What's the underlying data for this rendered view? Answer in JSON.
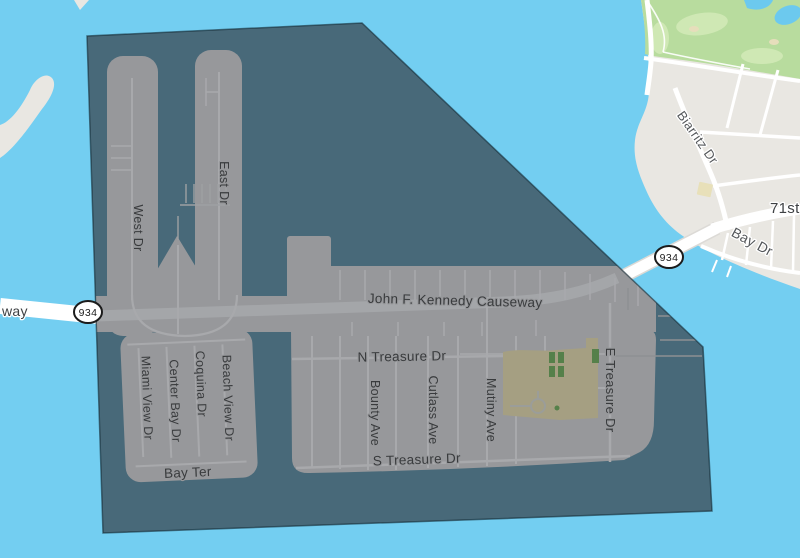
{
  "map": {
    "view": "street-map-with-selected-region-overlay",
    "colors": {
      "water": "#73cef1",
      "overlay_water": "#486979",
      "overlay_land": "#97989b",
      "overlay_road": "#a8a9ac",
      "land": "#e9e7e2",
      "road": "#ffffff",
      "golf_green": "#b8dc9e",
      "golf_green_light": "#cfe8b4",
      "pond_blue": "#6cc9ee",
      "park_tan_dimmed": "#a59f82",
      "park_green_dimmed": "#55804a",
      "building_beige": "#e8e0b9",
      "label_dimmed": "#393b3d",
      "label_outside": "#54575a"
    },
    "shields": {
      "west": "934",
      "east": "934"
    },
    "labels": {
      "partial_causeway": "way",
      "causeway": "John F. Kennedy Causeway",
      "west_dr": "West Dr",
      "east_dr": "East Dr",
      "n_treasure_dr": "N Treasure Dr",
      "s_treasure_dr": "S Treasure Dr",
      "e_treasure_dr": "E Treasure Dr",
      "bounty_ave": "Bounty Ave",
      "cutlass_ave": "Cutlass Ave",
      "mutiny_ave": "Mutiny Ave",
      "miami_view_dr": "Miami View Dr",
      "center_bay_dr": "Center Bay Dr",
      "coquina_dr": "Coquina Dr",
      "beach_view_dr": "Beach View Dr",
      "bay_ter": "Bay Ter",
      "biarritz_dr": "Biarritz Dr",
      "seventy_first_st": "71st St",
      "bay_dr": "Bay Dr"
    }
  }
}
